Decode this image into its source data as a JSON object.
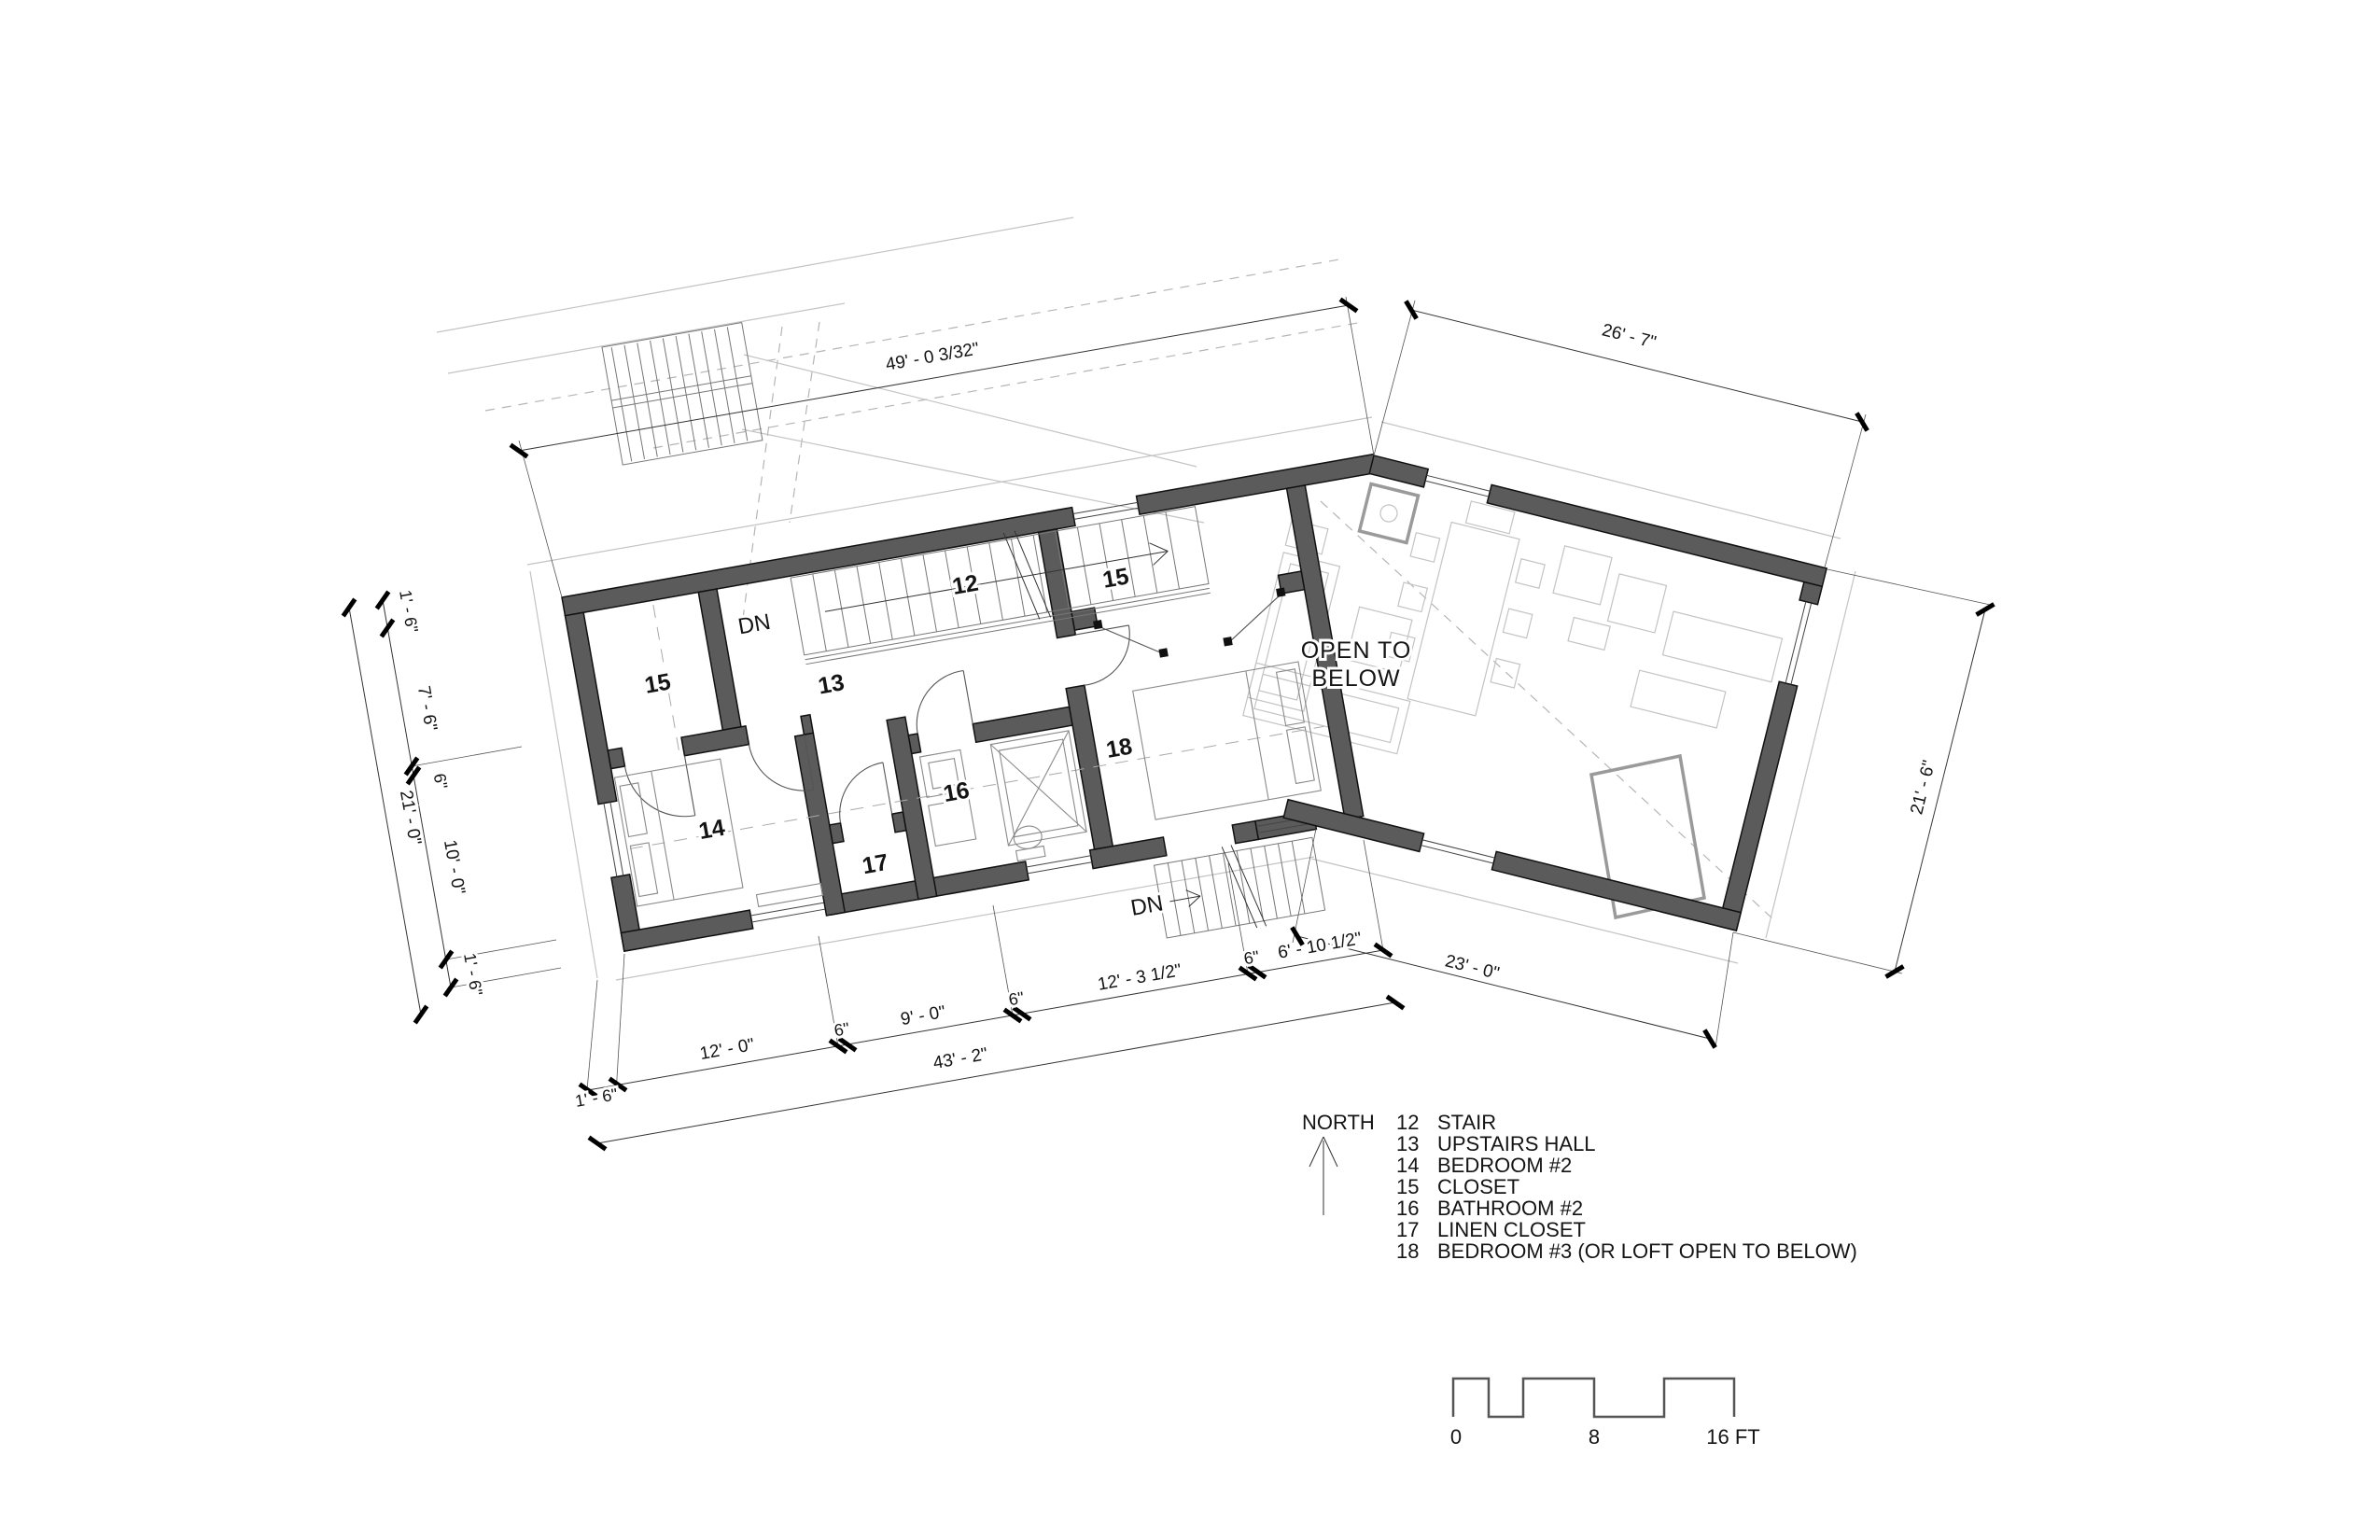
{
  "drawing": {
    "room_numbers": {
      "stair": "12",
      "upstairs_hall": "13",
      "bedroom_2": "14",
      "closet": "15",
      "bathroom_2": "16",
      "linen_closet": "17",
      "bedroom_3": "18"
    },
    "annotations": {
      "down_label": "DN",
      "open_below_line1": "OPEN TO",
      "open_below_line2": "BELOW"
    },
    "dimensions": {
      "upper_overall": "49' - 0 3/32\"",
      "top_right": "26' - 7\"",
      "right_side": "21' - 6\"",
      "bottom_right": "23' - 0\"",
      "bottom_overall": "43' - 2\"",
      "bottom_chain": [
        "1' - 6\"",
        "12' - 0\"",
        "6\"",
        "9' - 0\"",
        "6\"",
        "12' - 3 1/2\"",
        "6\"",
        "6' - 10 1/2\""
      ],
      "left_chain": [
        "1' - 6\"",
        "7' - 6\"",
        "6\"",
        "10' - 0\"",
        "1' - 6\""
      ],
      "left_overall": "21' - 0\""
    }
  },
  "legend": {
    "north_label": "NORTH",
    "rows": [
      {
        "num": "12",
        "name": "STAIR"
      },
      {
        "num": "13",
        "name": "UPSTAIRS HALL"
      },
      {
        "num": "14",
        "name": "BEDROOM #2"
      },
      {
        "num": "15",
        "name": "CLOSET"
      },
      {
        "num": "16",
        "name": "BATHROOM #2"
      },
      {
        "num": "17",
        "name": "LINEN CLOSET"
      },
      {
        "num": "18",
        "name": "BEDROOM #3 (OR LOFT OPEN TO BELOW)"
      }
    ]
  },
  "scale_bar": {
    "labels": [
      "0",
      "8",
      "16 FT"
    ]
  },
  "colors": {
    "wall_fill": "#5b5b5b",
    "ghost": "#c3c3c3",
    "ink": "#141414"
  }
}
